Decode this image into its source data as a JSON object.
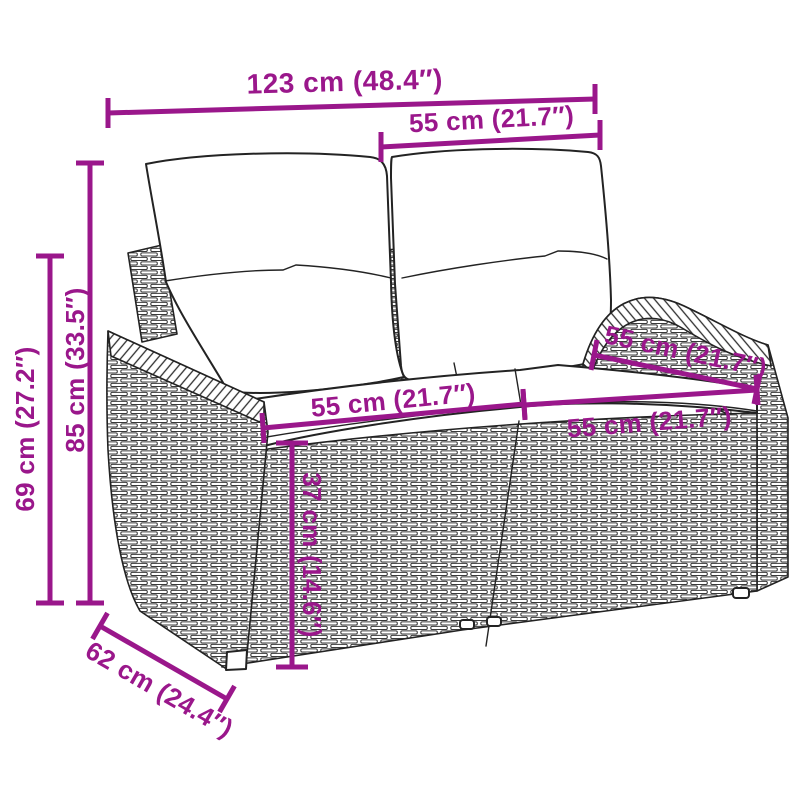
{
  "page": {
    "background": "#ffffff",
    "accent_color": "#9A178B",
    "line_art_color": "#232323",
    "illustration": "wicker-2-seater-garden-sofa-with-cushions"
  },
  "dimensions": {
    "overall_width": {
      "label": "123 cm (48.4″)",
      "cm": 123,
      "inches": 48.4
    },
    "backrest_width": {
      "label": "55 cm (21.7″)",
      "cm": 55,
      "inches": 21.7
    },
    "total_height": {
      "label": "85 cm (33.5″)",
      "cm": 85,
      "inches": 33.5
    },
    "armrest_height": {
      "label": "69 cm (27.2″)",
      "cm": 69,
      "inches": 27.2
    },
    "seat_width_left": {
      "label": "55 cm (21.7″)",
      "cm": 55,
      "inches": 21.7
    },
    "seat_depth": {
      "label": "55 cm (21.7″)",
      "cm": 55,
      "inches": 21.7
    },
    "seat_width_right": {
      "label": "55 cm (21.7″)",
      "cm": 55,
      "inches": 21.7
    },
    "seat_height": {
      "label": "37 cm (14.6″)",
      "cm": 37,
      "inches": 14.6
    },
    "overall_depth": {
      "label": "62 cm (24.4″)",
      "cm": 62,
      "inches": 24.4
    }
  }
}
